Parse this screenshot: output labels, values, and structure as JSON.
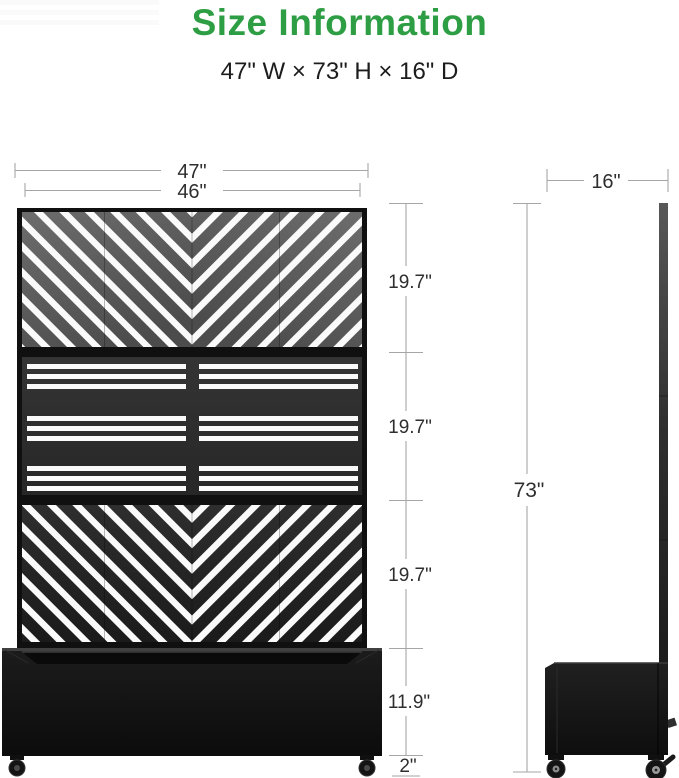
{
  "title": "Size Information",
  "subtitle": "47\" W × 73\" H × 16\" D",
  "dimensions": {
    "overall_width": "47\"",
    "panel_width": "46\"",
    "top_section_height": "19.7\"",
    "middle_section_height": "19.7\"",
    "bottom_section_height": "19.7\"",
    "planter_box_height": "11.9\"",
    "caster_height": "2\"",
    "total_height": "73\"",
    "depth": "16\""
  },
  "colors": {
    "title_green": "#2e9e44",
    "dimension_line": "#a6a6a6",
    "dimension_text": "#2f2f2f",
    "panel_top_gray": "#5f5f5f",
    "panel_middle_dark": "#2d2d2d",
    "panel_bottom_black": "#222222",
    "planter_black": "#121212",
    "stripe_white": "#fafafa"
  }
}
